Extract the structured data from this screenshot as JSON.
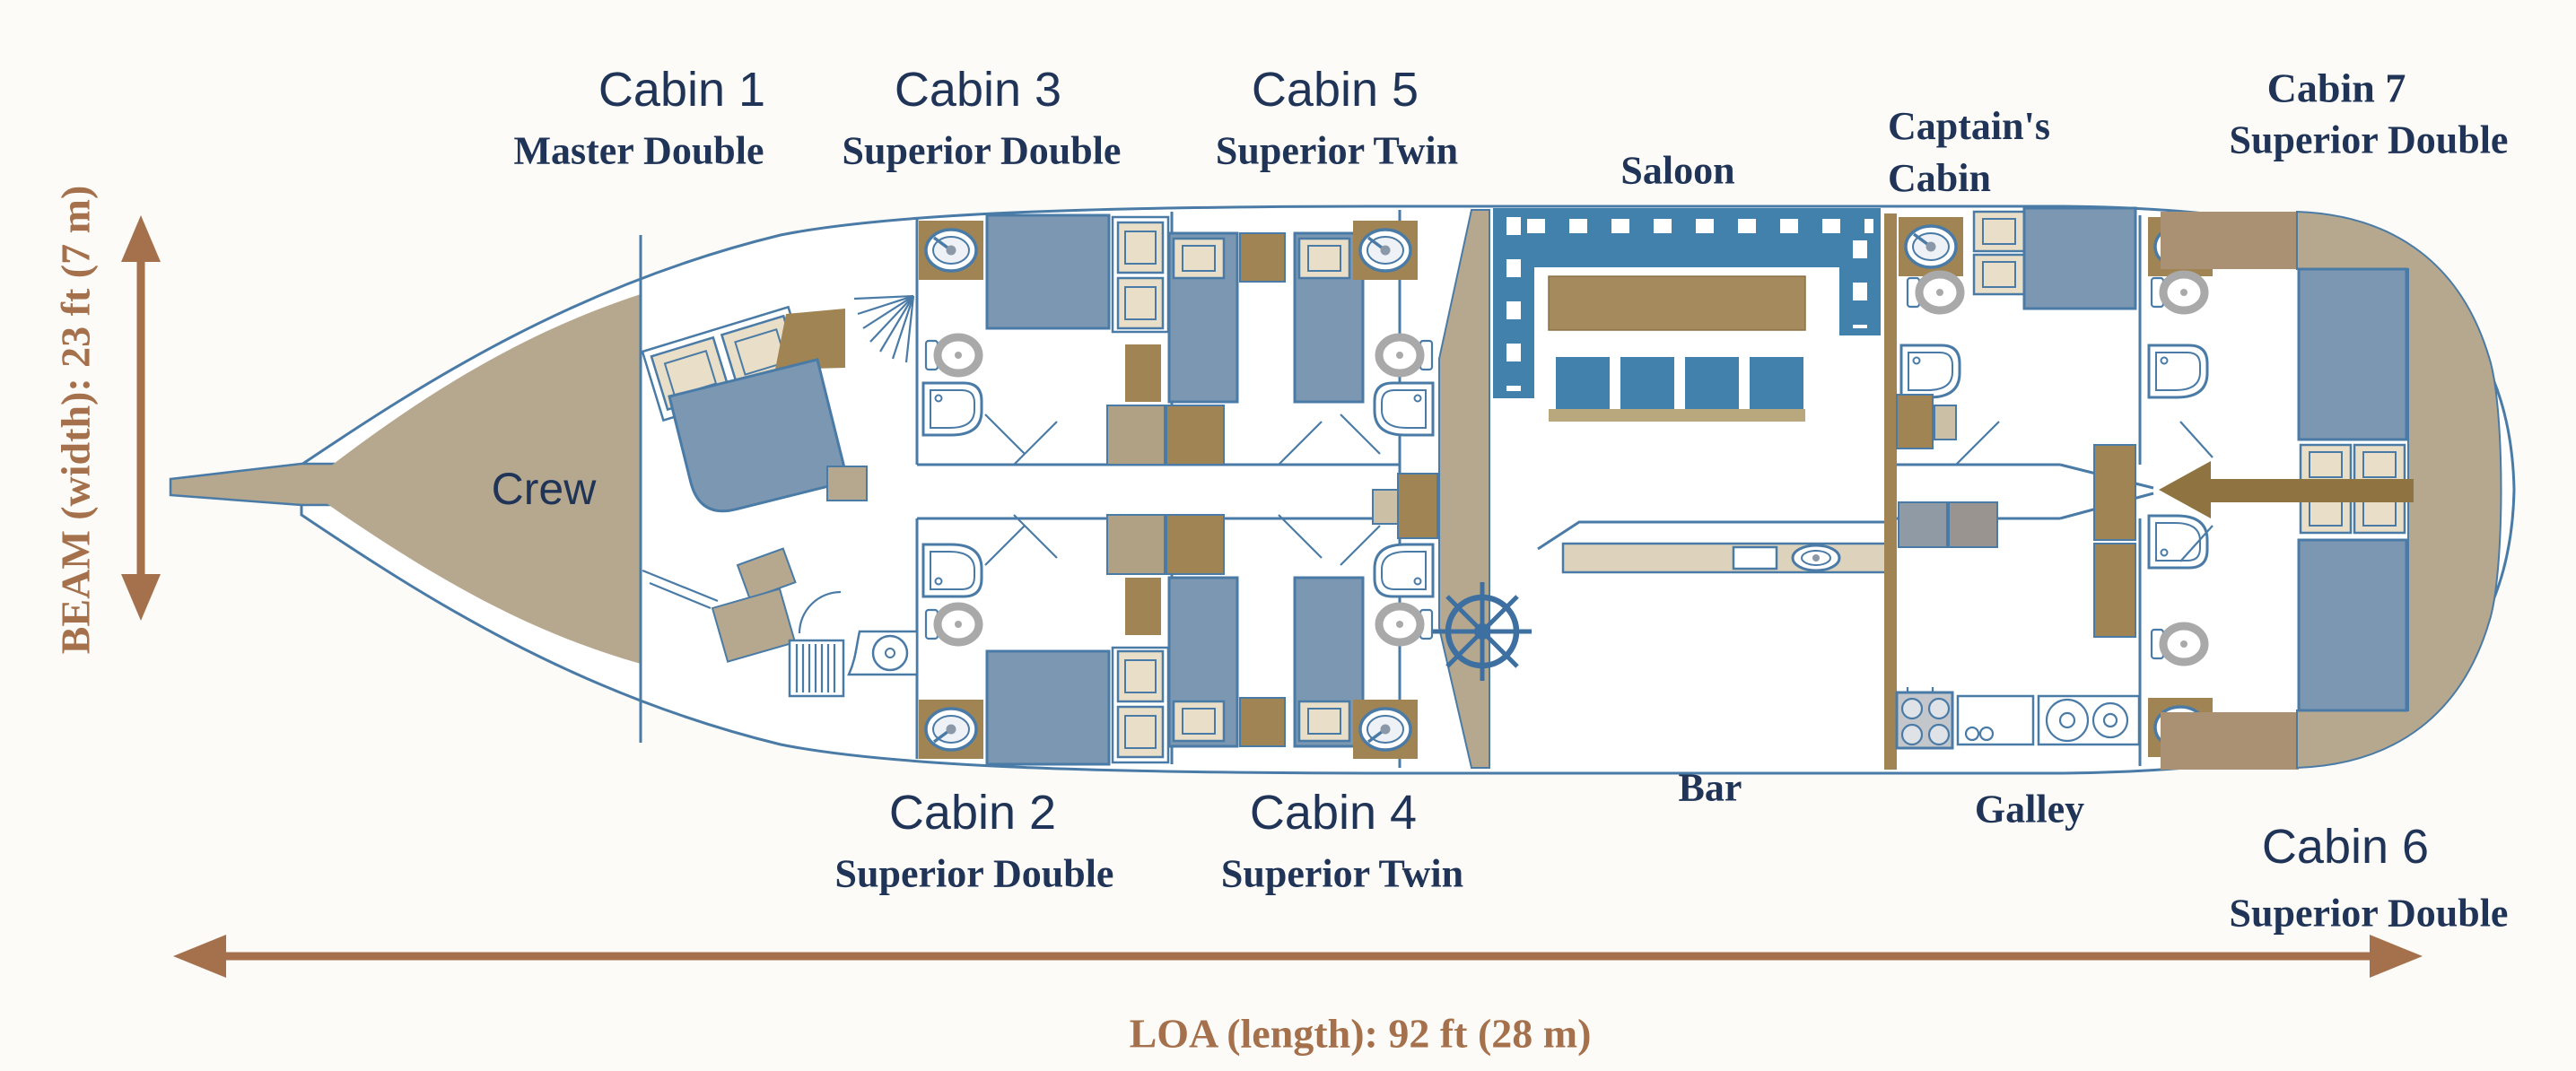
{
  "boat": {
    "crew_label": "Crew",
    "rooms": {
      "saloon": "Saloon",
      "bar": "Bar",
      "galley": "Galley",
      "captains_line1": "Captain's",
      "captains_line2": "Cabin"
    },
    "cabins": [
      {
        "title": "Cabin 1",
        "subtitle": "Master Double"
      },
      {
        "title": "Cabin 2",
        "subtitle": "Superior Double"
      },
      {
        "title": "Cabin 3",
        "subtitle": "Superior Double"
      },
      {
        "title": "Cabin 4",
        "subtitle": "Superior Twin"
      },
      {
        "title": "Cabin 5",
        "subtitle": "Superior Twin"
      },
      {
        "title": "Cabin 6",
        "subtitle": "Superior Double"
      },
      {
        "title": "Cabin 7",
        "subtitle": "Superior Double"
      }
    ],
    "dimensions": {
      "beam": "BEAM (width): 23 ft (7 m)",
      "loa": "LOA (length): 92 ft (28 m)"
    }
  },
  "palette": {
    "background": "#fcfbf8",
    "navy_text": "#1f3457",
    "dimension_brown": "#a5714c",
    "hull_outline": "#4a7ba6",
    "tan": "#b5a88e",
    "dark_tan": "#ab9173",
    "wood_brown": "#a18453",
    "bed_blue": "#7b97b2",
    "saloon_blue": "#4381ad",
    "cream": "#e9dec7",
    "gray": "#a9a9a9",
    "wheel_blue": "#3d6fa0",
    "entry_arrow_brown": "#8f7340"
  },
  "icons": {
    "ships_wheel": "ships-wheel-icon",
    "stairs": "companionway-stairs-icon",
    "sink": "sink-dial-icon",
    "toilet": "toilet-icon",
    "shower": "shower-icon",
    "stove": "stove-icon",
    "entry_arrow": "entry-arrow-icon",
    "beam_arrow": "beam-arrow-icon",
    "loa_arrow": "loa-arrow-icon"
  }
}
